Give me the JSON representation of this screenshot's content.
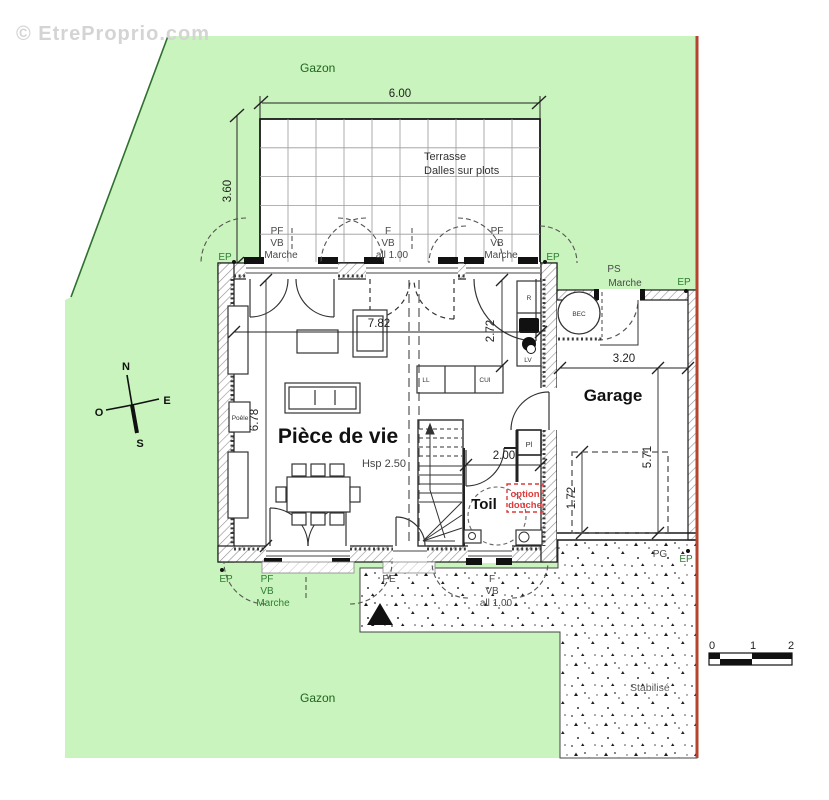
{
  "watermark": "© EtreProprio.com",
  "areas": {
    "lawn_top": "Gazon",
    "lawn_bottom": "Gazon",
    "stabilized": "Stabilisé",
    "terrace_line1": "Terrasse",
    "terrace_line2": "Dalles sur plots"
  },
  "rooms": {
    "living": {
      "name": "Pièce de vie",
      "ceiling": "Hsp 2.50"
    },
    "garage": "Garage",
    "toilet": "Toil"
  },
  "dimensions": {
    "terrace_width": "6.00",
    "terrace_depth": "3.60",
    "living_width": "7.82",
    "kitchen_depth": "2.72",
    "living_depth": "6.78",
    "garage_width": "3.20",
    "garage_depth": "5.71",
    "toilet_width": "2.00",
    "garage_clearance": "1.72"
  },
  "fixtures": {
    "stove": "Poêle",
    "water_heater": "BEC",
    "fridge": "R",
    "dishwasher": "LV",
    "washer": "LL",
    "kitchen": "CUI",
    "closet": "Pl",
    "shower_option_line1": "option",
    "shower_option_line2": "douche"
  },
  "openings": {
    "pf": "PF",
    "f": "F",
    "vb": "VB",
    "marche": "Marche",
    "all": "all 1.00",
    "pe": "PE",
    "pg": "PG",
    "ps": "PS",
    "ep": "EP"
  },
  "compass": {
    "north": "N",
    "south": "S",
    "east": "E",
    "west": "O"
  },
  "scale_bar": {
    "t0": "0",
    "t1": "1",
    "t2": "2"
  },
  "colors": {
    "lawn": "#c9f4bd",
    "boundary_red": "#b5452f",
    "option_red": "#e03a3a",
    "label_green": "#2e7d32"
  }
}
